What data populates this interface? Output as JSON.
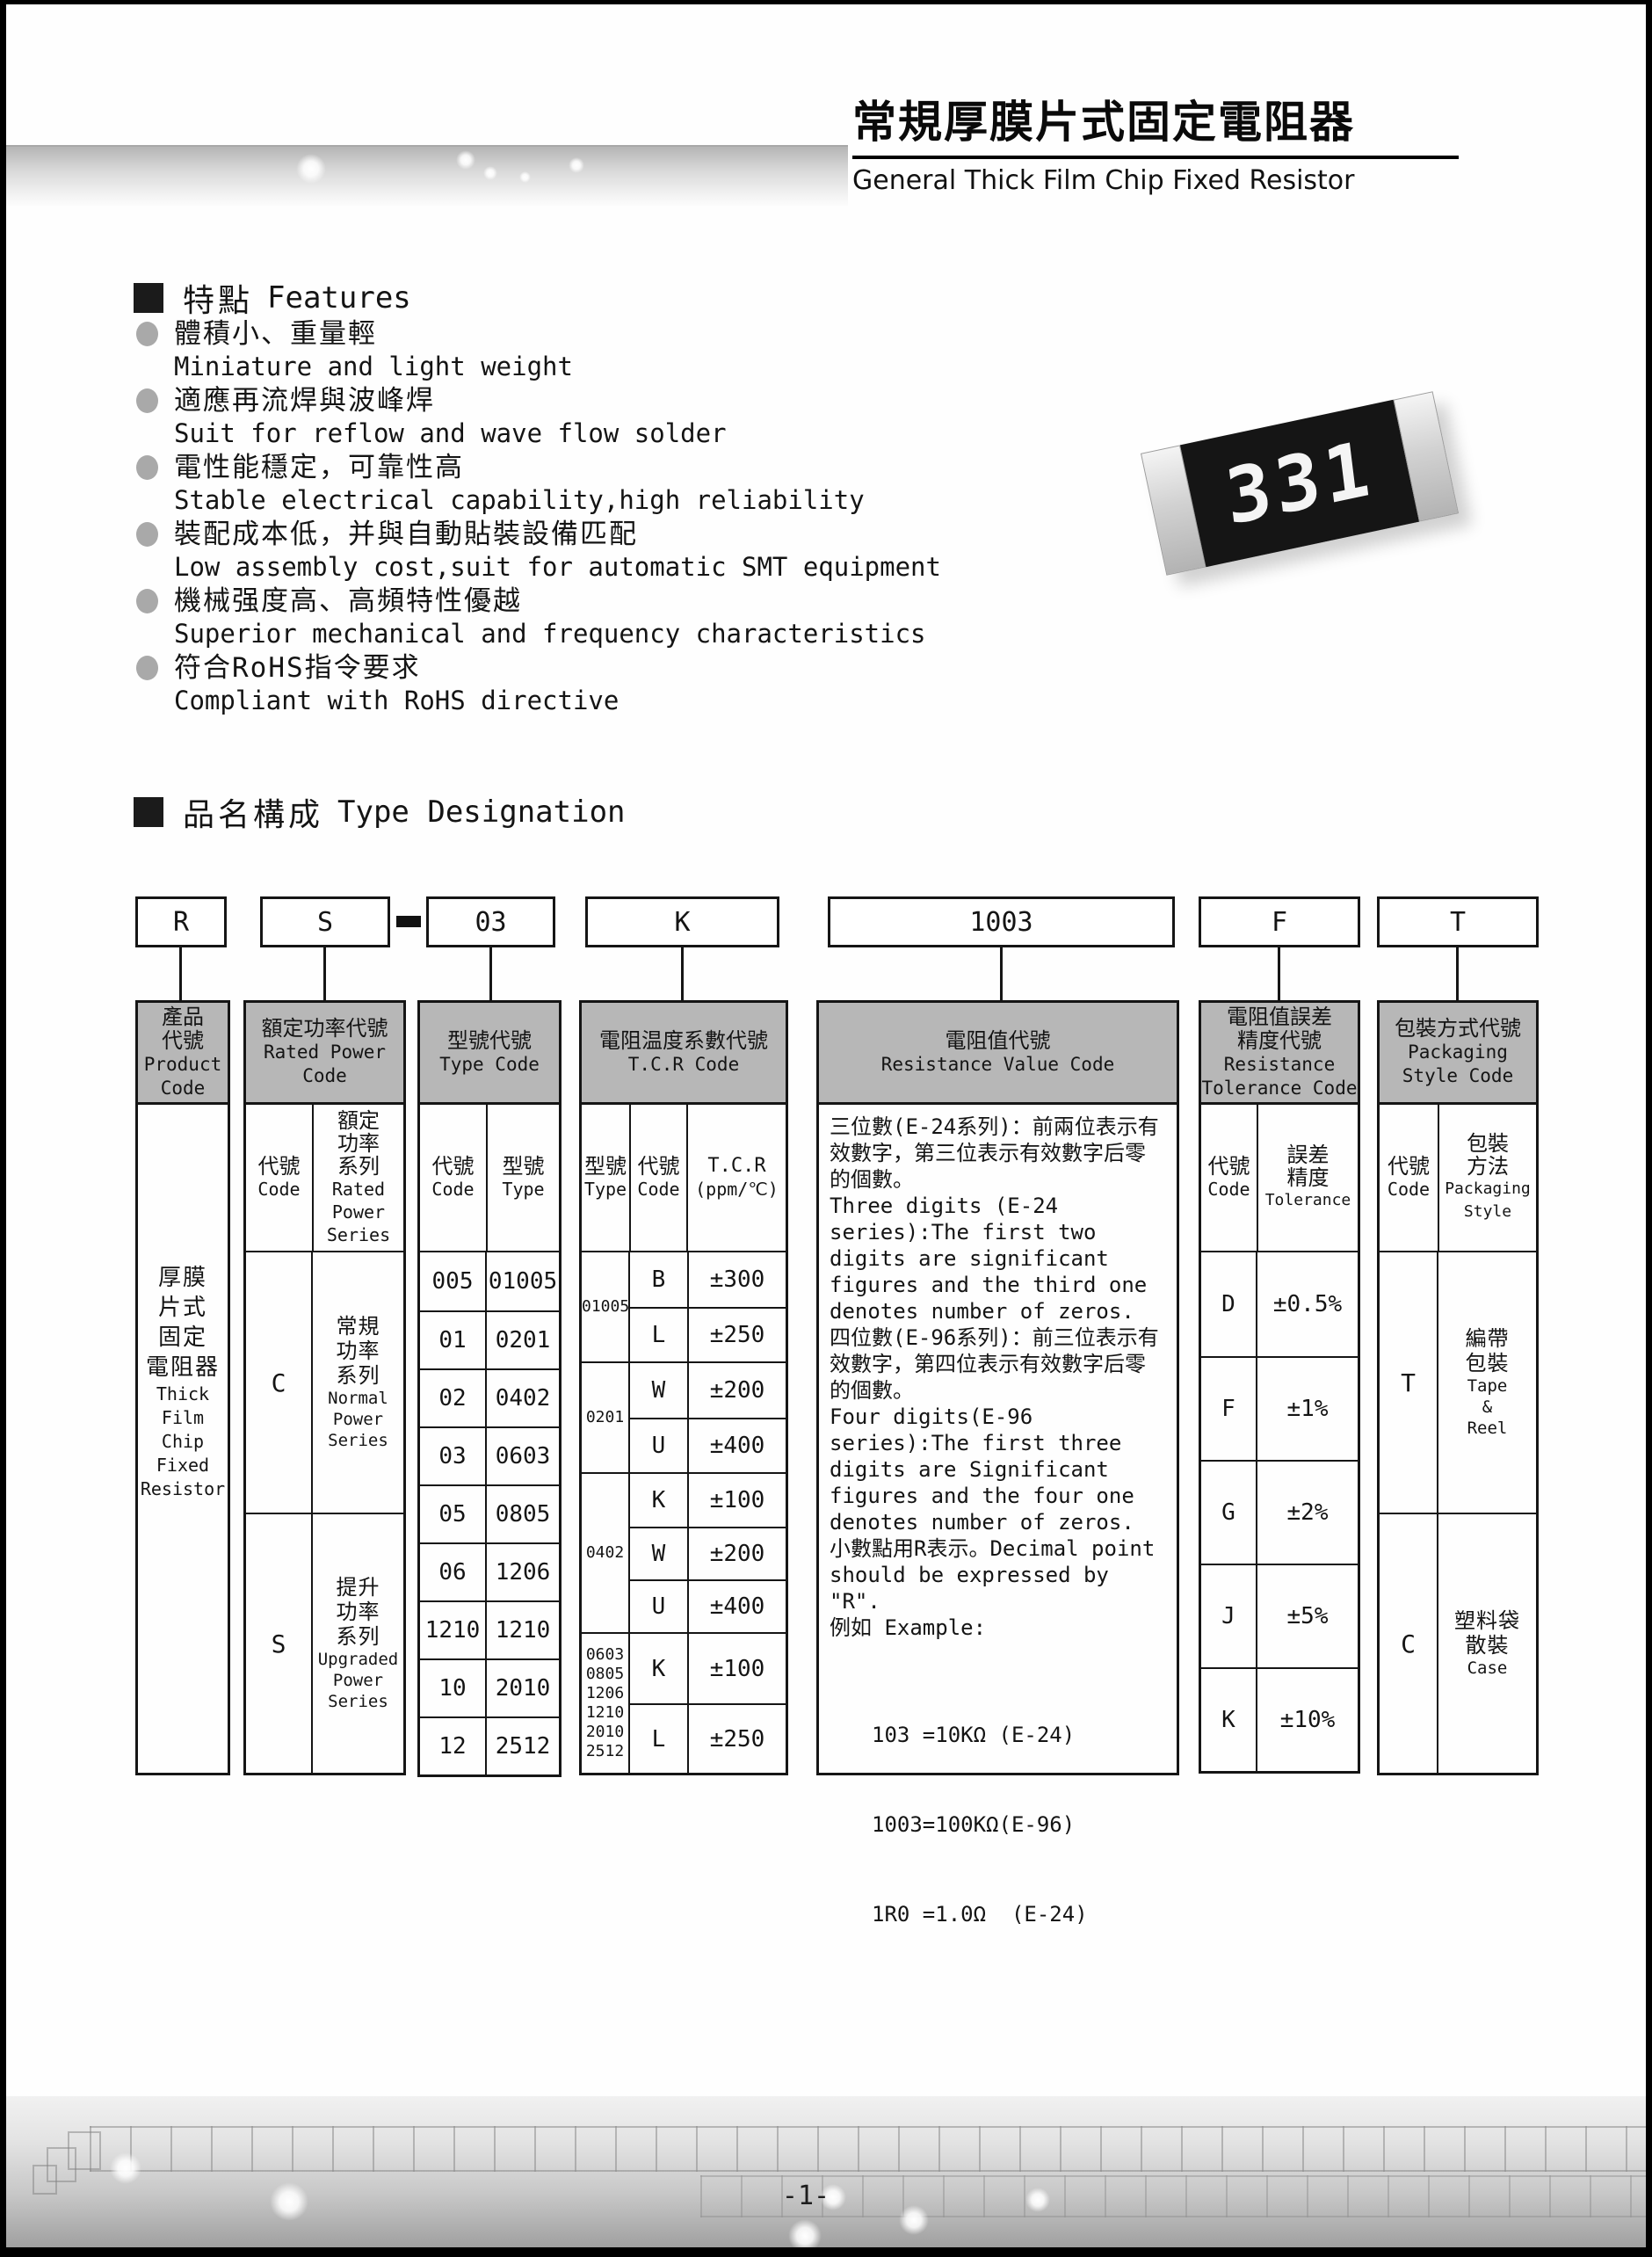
{
  "header": {
    "title_zh": "常規厚膜片式固定電阻器",
    "title_en": "General Thick Film Chip Fixed Resistor"
  },
  "features": {
    "heading_zh": "特點",
    "heading_en": "Features",
    "items": [
      {
        "zh": "體積小、重量輕",
        "en": "Miniature and light weight"
      },
      {
        "zh": "適應再流焊與波峰焊",
        "en": "Suit for reflow and wave flow solder"
      },
      {
        "zh": "電性能穩定，可靠性高",
        "en": "Stable electrical capability,high reliability"
      },
      {
        "zh": "裝配成本低，并與自動貼裝設備匹配",
        "en": "Low assembly cost,suit for automatic SMT equipment"
      },
      {
        "zh": "機械强度高、高頻特性優越",
        "en": "Superior mechanical and frequency characteristics"
      },
      {
        "zh": "符合RoHS指令要求",
        "en": "Compliant with RoHS directive"
      }
    ]
  },
  "chip": {
    "marking": "331"
  },
  "designation": {
    "heading_zh": "品名構成",
    "heading_en": "Type Designation",
    "boxes": [
      "R",
      "S",
      "03",
      "K",
      "1003",
      "F",
      "T"
    ],
    "separator_dash": "-"
  },
  "cols": {
    "product": {
      "header": [
        "產品",
        "代號",
        "Product",
        "Code"
      ],
      "body": [
        "厚膜",
        "片式",
        "固定",
        "電阻器",
        "Thick",
        "Film",
        "Chip",
        "Fixed",
        "Resistor"
      ]
    },
    "power": {
      "header": [
        "額定功率代號",
        "Rated Power",
        "Code"
      ],
      "sub_code": [
        "代號",
        "Code"
      ],
      "sub_series": [
        "額定",
        "功率",
        "系列",
        "Rated",
        "Power",
        "Series"
      ],
      "rows": [
        {
          "code": "C",
          "series": [
            "常規",
            "功率",
            "系列",
            "Normal",
            "Power",
            "Series"
          ]
        },
        {
          "code": "S",
          "series": [
            "提升",
            "功率",
            "系列",
            "Upgraded",
            "Power",
            "Series"
          ]
        }
      ]
    },
    "type": {
      "header": [
        "型號代號",
        "Type Code"
      ],
      "sub_code": [
        "代號",
        "Code"
      ],
      "sub_type": [
        "型號",
        "Type"
      ],
      "rows": [
        {
          "code": "005",
          "type": "01005"
        },
        {
          "code": "01",
          "type": "0201"
        },
        {
          "code": "02",
          "type": "0402"
        },
        {
          "code": "03",
          "type": "0603"
        },
        {
          "code": "05",
          "type": "0805"
        },
        {
          "code": "06",
          "type": "1206"
        },
        {
          "code": "1210",
          "type": "1210"
        },
        {
          "code": "10",
          "type": "2010"
        },
        {
          "code": "12",
          "type": "2512"
        }
      ]
    },
    "tcr": {
      "header": [
        "電阻温度系數代號",
        "T.C.R Code"
      ],
      "sub_type": [
        "型號",
        "Type"
      ],
      "sub_code": [
        "代號",
        "Code"
      ],
      "sub_tcr": [
        "T.C.R",
        "(ppm/℃)"
      ],
      "groups": [
        {
          "types": [
            "01005"
          ],
          "rows": [
            {
              "code": "B",
              "val": "±300"
            },
            {
              "code": "L",
              "val": "±250"
            }
          ]
        },
        {
          "types": [
            "0201"
          ],
          "rows": [
            {
              "code": "W",
              "val": "±200"
            },
            {
              "code": "U",
              "val": "±400"
            }
          ]
        },
        {
          "types": [
            "0402"
          ],
          "rows": [
            {
              "code": "K",
              "val": "±100"
            },
            {
              "code": "W",
              "val": "±200"
            },
            {
              "code": "U",
              "val": "±400"
            }
          ]
        },
        {
          "types": [
            "0603",
            "0805",
            "1206",
            "1210",
            "2010",
            "2512"
          ],
          "rows": [
            {
              "code": "K",
              "val": "±100"
            },
            {
              "code": "L",
              "val": "±250"
            }
          ]
        }
      ]
    },
    "resistance": {
      "header": [
        "電阻值代號",
        "Resistance Value Code"
      ],
      "paragraphs": [
        "三位數(E-24系列)：前兩位表示有效數字，第三位表示有效數字后零的個數。",
        "Three digits (E-24 series):The first two digits are significant figures and the third one denotes number of zeros.",
        "四位數(E-96系列)：前三位表示有效數字，第四位表示有效數字后零的個數。",
        "Four digits(E-96 series):The first three digits are Significant figures and the four one denotes number of zeros.",
        "小數點用R表示。Decimal point should be expressed by \"R\".",
        "例如 Example:"
      ],
      "examples": [
        "103 =10KΩ (E-24)",
        "1003=100KΩ(E-96)",
        "1R0 =1.0Ω  (E-24)"
      ]
    },
    "tolerance": {
      "header": [
        "電阻值誤差",
        "精度代號",
        "Resistance",
        "Tolerance Code"
      ],
      "sub_code": [
        "代號",
        "Code"
      ],
      "sub_tol": [
        "誤差",
        "精度",
        "Tolerance"
      ],
      "rows": [
        {
          "code": "D",
          "val": "±0.5%"
        },
        {
          "code": "F",
          "val": "±1%"
        },
        {
          "code": "G",
          "val": "±2%"
        },
        {
          "code": "J",
          "val": "±5%"
        },
        {
          "code": "K",
          "val": "±10%"
        }
      ]
    },
    "packaging": {
      "header": [
        "包裝方式代號",
        "Packaging",
        "Style Code"
      ],
      "sub_code": [
        "代號",
        "Code"
      ],
      "sub_style": [
        "包裝",
        "方法",
        "Packaging",
        "Style"
      ],
      "rows": [
        {
          "code": "T",
          "style": [
            "編帶",
            "包裝",
            "Tape",
            "&",
            "Reel"
          ]
        },
        {
          "code": "C",
          "style": [
            "塑料袋",
            "散裝",
            "Case"
          ]
        }
      ]
    }
  },
  "footer": {
    "page_number": "-1-"
  }
}
